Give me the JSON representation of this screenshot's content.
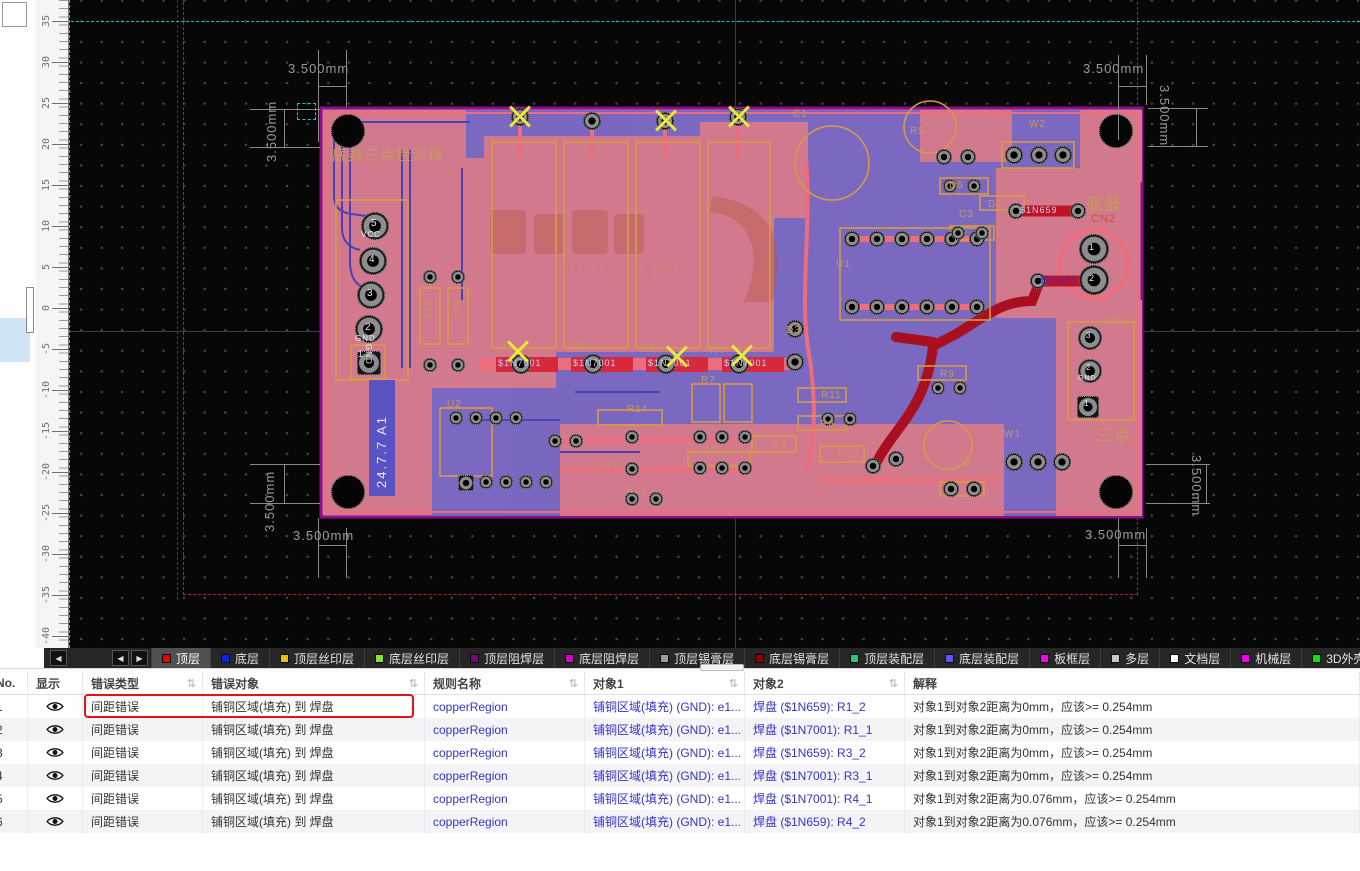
{
  "colors": {
    "tan": "#c79a58",
    "white": "#ecebf4",
    "red": "#e0483c",
    "lightblue": "#ccd0f8",
    "darkblue": "#3030c0",
    "board_pink": "#d2798d",
    "pour_blue": "#6e65c8",
    "board_edge": "#8e0d8e",
    "highlight_red": "#e81111",
    "link_blue": "#3434cc",
    "guide_teal": "#00c9c9"
  },
  "canvas": {
    "ruler": {
      "values": [
        35,
        30,
        25,
        20,
        15,
        10,
        5,
        0,
        -5,
        -10,
        -15,
        -20,
        -25,
        -30,
        -35,
        -40
      ],
      "zero_y": 308,
      "px_per_unit": 8.2
    },
    "dimension_label": "3.500mm",
    "watermark": "Flyover AI",
    "board": {
      "version_text": "24.7.7 A1",
      "labels": [
        {
          "t": "底鼓三点检测板",
          "x": 332,
          "y": 148,
          "c": "tan",
          "s": 15,
          "r": 0
        },
        {
          "t": "底鼓",
          "x": 1086,
          "y": 196,
          "c": "tan",
          "s": 17,
          "r": 0
        },
        {
          "t": "三点",
          "x": 1096,
          "y": 427,
          "c": "tan",
          "s": 17,
          "r": 0
        },
        {
          "t": "CN2",
          "x": 1091,
          "y": 214,
          "c": "red",
          "s": 11,
          "r": 0
        },
        {
          "t": "CN3",
          "x": 1104,
          "y": 316,
          "c": "tan",
          "s": 11,
          "r": 0
        },
        {
          "t": "R5",
          "x": 910,
          "y": 127,
          "c": "tan",
          "s": 10,
          "r": 0
        },
        {
          "t": "C1",
          "x": 793,
          "y": 110,
          "c": "tan",
          "s": 10,
          "r": 0
        },
        {
          "t": "W2",
          "x": 1029,
          "y": 120,
          "c": "tan",
          "s": 10,
          "r": 0
        },
        {
          "t": "D5",
          "x": 949,
          "y": 181,
          "c": "tan",
          "s": 10,
          "r": 0
        },
        {
          "t": "C3",
          "x": 959,
          "y": 210,
          "c": "tan",
          "s": 10,
          "r": 0
        },
        {
          "t": "D2",
          "x": 988,
          "y": 200,
          "c": "tan",
          "s": 10,
          "r": 0
        },
        {
          "t": "U1",
          "x": 836,
          "y": 260,
          "c": "tan",
          "s": 10,
          "r": 0
        },
        {
          "t": "D3",
          "x": 786,
          "y": 326,
          "c": "tan",
          "s": 10,
          "r": 0
        },
        {
          "t": "R1",
          "x": 500,
          "y": 342,
          "c": "tan",
          "s": 10,
          "r": 0
        },
        {
          "t": "R2",
          "x": 572,
          "y": 342,
          "c": "tan",
          "s": 10,
          "r": 0
        },
        {
          "t": "R3",
          "x": 641,
          "y": 344,
          "c": "tan",
          "s": 10,
          "r": 0
        },
        {
          "t": "R4",
          "x": 710,
          "y": 346,
          "c": "tan",
          "s": 10,
          "r": 0
        },
        {
          "t": "R7",
          "x": 701,
          "y": 376,
          "c": "tan",
          "s": 10,
          "r": 0
        },
        {
          "t": "R14",
          "x": 627,
          "y": 405,
          "c": "tan",
          "s": 10,
          "r": 0
        },
        {
          "t": "R15",
          "x": 626,
          "y": 486,
          "c": "tan",
          "s": 10,
          "r": 0
        },
        {
          "t": "D1",
          "x": 604,
          "y": 461,
          "c": "tan",
          "s": 10,
          "r": 0
        },
        {
          "t": "R12",
          "x": 702,
          "y": 446,
          "c": "tan",
          "s": 10,
          "r": 0
        },
        {
          "t": "R8",
          "x": 772,
          "y": 441,
          "c": "tan",
          "s": 10,
          "r": 0
        },
        {
          "t": "R10",
          "x": 838,
          "y": 450,
          "c": "tan",
          "s": 10,
          "r": 0
        },
        {
          "t": "R6",
          "x": 820,
          "y": 420,
          "c": "tan",
          "s": 10,
          "r": 0
        },
        {
          "t": "R11",
          "x": 821,
          "y": 391,
          "c": "tan",
          "s": 10,
          "r": 0
        },
        {
          "t": "R9",
          "x": 940,
          "y": 370,
          "c": "tan",
          "s": 10,
          "r": 0
        },
        {
          "t": "W1",
          "x": 1004,
          "y": 430,
          "c": "tan",
          "s": 10,
          "r": 0
        },
        {
          "t": "D4",
          "x": 956,
          "y": 459,
          "c": "tan",
          "s": 10,
          "r": 0
        },
        {
          "t": "U2",
          "x": 447,
          "y": 400,
          "c": "tan",
          "s": 10,
          "r": 0
        },
        {
          "t": "R16",
          "x": 432,
          "y": 300,
          "c": "tan",
          "s": 9,
          "r": 90
        },
        {
          "t": "R17",
          "x": 460,
          "y": 300,
          "c": "tan",
          "s": 9,
          "r": 90
        },
        {
          "t": "5",
          "x": 371,
          "y": 219,
          "c": "white",
          "s": 10,
          "r": 0
        },
        {
          "t": "VCC",
          "x": 361,
          "y": 231,
          "c": "white",
          "s": 8,
          "r": 0
        },
        {
          "t": "4",
          "x": 369,
          "y": 255,
          "c": "white",
          "s": 10,
          "r": 0
        },
        {
          "t": "3",
          "x": 367,
          "y": 289,
          "c": "white",
          "s": 10,
          "r": 0
        },
        {
          "t": "2",
          "x": 365,
          "y": 323,
          "c": "white",
          "s": 10,
          "r": 0
        },
        {
          "t": "GND",
          "x": 355,
          "y": 335,
          "c": "white",
          "s": 8,
          "r": 0
        },
        {
          "t": "1",
          "x": 358,
          "y": 350,
          "c": "white",
          "s": 9,
          "r": 0
        },
        {
          "t": "GND",
          "x": 372,
          "y": 344,
          "c": "white",
          "s": 8,
          "r": 90
        },
        {
          "t": "1",
          "x": 1089,
          "y": 243,
          "c": "white",
          "s": 9,
          "r": 0
        },
        {
          "t": "2",
          "x": 1089,
          "y": 274,
          "c": "white",
          "s": 9,
          "r": 0
        },
        {
          "t": "3",
          "x": 1086,
          "y": 332,
          "c": "white",
          "s": 8,
          "r": 0
        },
        {
          "t": "2",
          "x": 1086,
          "y": 364,
          "c": "white",
          "s": 8,
          "r": 0
        },
        {
          "t": "GND",
          "x": 1078,
          "y": 375,
          "c": "white",
          "s": 7,
          "r": 0
        },
        {
          "t": "1",
          "x": 1084,
          "y": 400,
          "c": "white",
          "s": 8,
          "r": 0
        },
        {
          "t": "$1N7001",
          "x": 498,
          "y": 359,
          "c": "lightblue",
          "s": 9,
          "r": 0
        },
        {
          "t": "$1N7001",
          "x": 573,
          "y": 359,
          "c": "lightblue",
          "s": 9,
          "r": 0
        },
        {
          "t": "$1N7001",
          "x": 648,
          "y": 359,
          "c": "lightblue",
          "s": 9,
          "r": 0
        },
        {
          "t": "$1N7001",
          "x": 724,
          "y": 359,
          "c": "lightblue",
          "s": 9,
          "r": 0
        },
        {
          "t": "$1N659",
          "x": 1020,
          "y": 206,
          "c": "lightblue",
          "s": 9,
          "r": 0
        },
        {
          "t": "$1N659",
          "x": 1040,
          "y": 276,
          "c": "darkblue",
          "s": 9,
          "r": 0
        }
      ],
      "pads": [
        [
          375,
          226,
          14
        ],
        [
          373,
          261,
          14
        ],
        [
          371,
          295,
          14
        ],
        [
          369,
          329,
          14
        ],
        [
          520,
          117,
          9
        ],
        [
          592,
          121,
          9
        ],
        [
          665,
          121,
          9
        ],
        [
          738,
          117,
          9
        ],
        [
          521,
          364,
          10
        ],
        [
          593,
          364,
          10
        ],
        [
          666,
          364,
          10
        ],
        [
          739,
          364,
          10
        ],
        [
          795,
          362,
          9
        ],
        [
          430,
          277,
          7
        ],
        [
          458,
          277,
          7
        ],
        [
          430,
          365,
          7
        ],
        [
          458,
          365,
          7
        ],
        [
          456,
          418,
          7
        ],
        [
          476,
          418,
          7
        ],
        [
          496,
          418,
          7
        ],
        [
          516,
          418,
          7
        ],
        [
          466,
          482,
          7
        ],
        [
          486,
          482,
          7
        ],
        [
          506,
          482,
          7
        ],
        [
          526,
          482,
          7
        ],
        [
          546,
          482,
          7
        ],
        [
          555,
          441,
          7
        ],
        [
          576,
          441,
          7
        ],
        [
          632,
          437,
          7
        ],
        [
          632,
          469,
          7
        ],
        [
          632,
          499,
          7
        ],
        [
          656,
          499,
          7
        ],
        [
          700,
          437,
          7
        ],
        [
          722,
          437,
          7
        ],
        [
          745,
          437,
          7
        ],
        [
          700,
          468,
          7
        ],
        [
          722,
          468,
          7
        ],
        [
          745,
          468,
          7
        ],
        [
          852,
          239,
          8
        ],
        [
          877,
          239,
          8
        ],
        [
          902,
          239,
          8
        ],
        [
          927,
          239,
          8
        ],
        [
          952,
          239,
          8
        ],
        [
          977,
          239,
          8
        ],
        [
          852,
          307,
          8
        ],
        [
          877,
          307,
          8
        ],
        [
          902,
          307,
          8
        ],
        [
          927,
          307,
          8
        ],
        [
          952,
          307,
          8
        ],
        [
          977,
          307,
          8
        ],
        [
          795,
          329,
          9
        ],
        [
          944,
          157,
          8
        ],
        [
          968,
          157,
          8
        ],
        [
          1014,
          155,
          9
        ],
        [
          1039,
          155,
          9
        ],
        [
          1063,
          155,
          9
        ],
        [
          950,
          186,
          7
        ],
        [
          974,
          186,
          7
        ],
        [
          958,
          233,
          7
        ],
        [
          982,
          233,
          7
        ],
        [
          1016,
          211,
          8
        ],
        [
          1078,
          211,
          8
        ],
        [
          1038,
          281,
          8
        ],
        [
          1094,
          249,
          15
        ],
        [
          1094,
          280,
          15
        ],
        [
          1090,
          338,
          12
        ],
        [
          1090,
          371,
          12
        ],
        [
          938,
          388,
          7
        ],
        [
          960,
          388,
          7
        ],
        [
          828,
          419,
          7
        ],
        [
          850,
          419,
          7
        ],
        [
          873,
          466,
          8
        ],
        [
          896,
          459,
          8
        ],
        [
          1014,
          462,
          9
        ],
        [
          1038,
          462,
          9
        ],
        [
          1062,
          462,
          9
        ],
        [
          951,
          489,
          8
        ],
        [
          974,
          489,
          8
        ]
      ],
      "square_pads": [
        [
          357,
          351,
          24
        ],
        [
          1077,
          396,
          22
        ],
        [
          458,
          475,
          16
        ]
      ],
      "holes": [
        [
          348,
          131
        ],
        [
          1116,
          131
        ],
        [
          348,
          492
        ],
        [
          1116,
          492
        ]
      ],
      "error_markers": [
        [
          520,
          117
        ],
        [
          666,
          121
        ],
        [
          739,
          117
        ],
        [
          518,
          352
        ],
        [
          677,
          357
        ],
        [
          742,
          356
        ]
      ]
    }
  },
  "layer_bar": {
    "scroll_left": "◀",
    "scroll_right": "▶",
    "tabs": [
      {
        "label": "顶层",
        "color": "#e60000",
        "active": true
      },
      {
        "label": "底层",
        "color": "#0f23e8",
        "active": false
      },
      {
        "label": "顶层丝印层",
        "color": "#e2c410",
        "active": false
      },
      {
        "label": "底层丝印层",
        "color": "#8ae234",
        "active": false
      },
      {
        "label": "顶层阻焊层",
        "color": "#77077a",
        "active": false
      },
      {
        "label": "底层阻焊层",
        "color": "#c20ac2",
        "active": false
      },
      {
        "label": "顶层锡膏层",
        "color": "#9c9c9c",
        "active": false
      },
      {
        "label": "底层锡膏层",
        "color": "#8b0000",
        "active": false
      },
      {
        "label": "顶层装配层",
        "color": "#2ec27e",
        "active": false
      },
      {
        "label": "底层装配层",
        "color": "#5a5af5",
        "active": false
      },
      {
        "label": "板框层",
        "color": "#f500f5",
        "active": false
      },
      {
        "label": "多层",
        "color": "#c8c8c8",
        "active": false
      },
      {
        "label": "文档层",
        "color": "#ffffff",
        "active": false
      },
      {
        "label": "机械层",
        "color": "#f000f0",
        "active": false
      },
      {
        "label": "3D外壳边框层",
        "color": "#00e800",
        "active": false
      },
      {
        "label": "3D外壳顶层",
        "color": "#f5c2f0",
        "active": false
      }
    ]
  },
  "table": {
    "columns": [
      {
        "label": "No.",
        "width": 28,
        "sortable": false,
        "clip": true
      },
      {
        "label": "显示",
        "width": 55,
        "sortable": false,
        "clip": false
      },
      {
        "label": "错误类型",
        "width": 120,
        "sortable": true,
        "clip": false
      },
      {
        "label": "错误对象",
        "width": 222,
        "sortable": true,
        "clip": false
      },
      {
        "label": "规则名称",
        "width": 160,
        "sortable": true,
        "clip": false
      },
      {
        "label": "对象1",
        "width": 160,
        "sortable": true,
        "clip": false
      },
      {
        "label": "对象2",
        "width": 160,
        "sortable": true,
        "clip": false
      },
      {
        "label": "解释",
        "width": 455,
        "sortable": false,
        "clip": false
      }
    ],
    "rows": [
      {
        "no": "1",
        "error_type": "间距错误",
        "error_object": "铺铜区域(填充) 到 焊盘",
        "rule": "copperRegion",
        "obj1": "铺铜区域(填充) (GND): e1...",
        "obj2": "焊盘 ($1N659): R1_2",
        "explain": "对象1到对象2距离为0mm，应该>= 0.254mm",
        "highlight": true
      },
      {
        "no": "2",
        "error_type": "间距错误",
        "error_object": "铺铜区域(填充) 到 焊盘",
        "rule": "copperRegion",
        "obj1": "铺铜区域(填充) (GND): e1...",
        "obj2": "焊盘 ($1N7001): R1_1",
        "explain": "对象1到对象2距离为0mm，应该>= 0.254mm",
        "highlight": false
      },
      {
        "no": "3",
        "error_type": "间距错误",
        "error_object": "铺铜区域(填充) 到 焊盘",
        "rule": "copperRegion",
        "obj1": "铺铜区域(填充) (GND): e1...",
        "obj2": "焊盘 ($1N659): R3_2",
        "explain": "对象1到对象2距离为0mm，应该>= 0.254mm",
        "highlight": false
      },
      {
        "no": "4",
        "error_type": "间距错误",
        "error_object": "铺铜区域(填充) 到 焊盘",
        "rule": "copperRegion",
        "obj1": "铺铜区域(填充) (GND): e1...",
        "obj2": "焊盘 ($1N7001): R3_1",
        "explain": "对象1到对象2距离为0mm，应该>= 0.254mm",
        "highlight": false
      },
      {
        "no": "5",
        "error_type": "间距错误",
        "error_object": "铺铜区域(填充) 到 焊盘",
        "rule": "copperRegion",
        "obj1": "铺铜区域(填充) (GND): e1...",
        "obj2": "焊盘 ($1N7001): R4_1",
        "explain": "对象1到对象2距离为0.076mm，应该>= 0.254mm",
        "highlight": false
      },
      {
        "no": "6",
        "error_type": "间距错误",
        "error_object": "铺铜区域(填充) 到 焊盘",
        "rule": "copperRegion",
        "obj1": "铺铜区域(填充) (GND): e1...",
        "obj2": "焊盘 ($1N659): R4_2",
        "explain": "对象1到对象2距离为0.076mm，应该>= 0.254mm",
        "highlight": false
      }
    ]
  }
}
